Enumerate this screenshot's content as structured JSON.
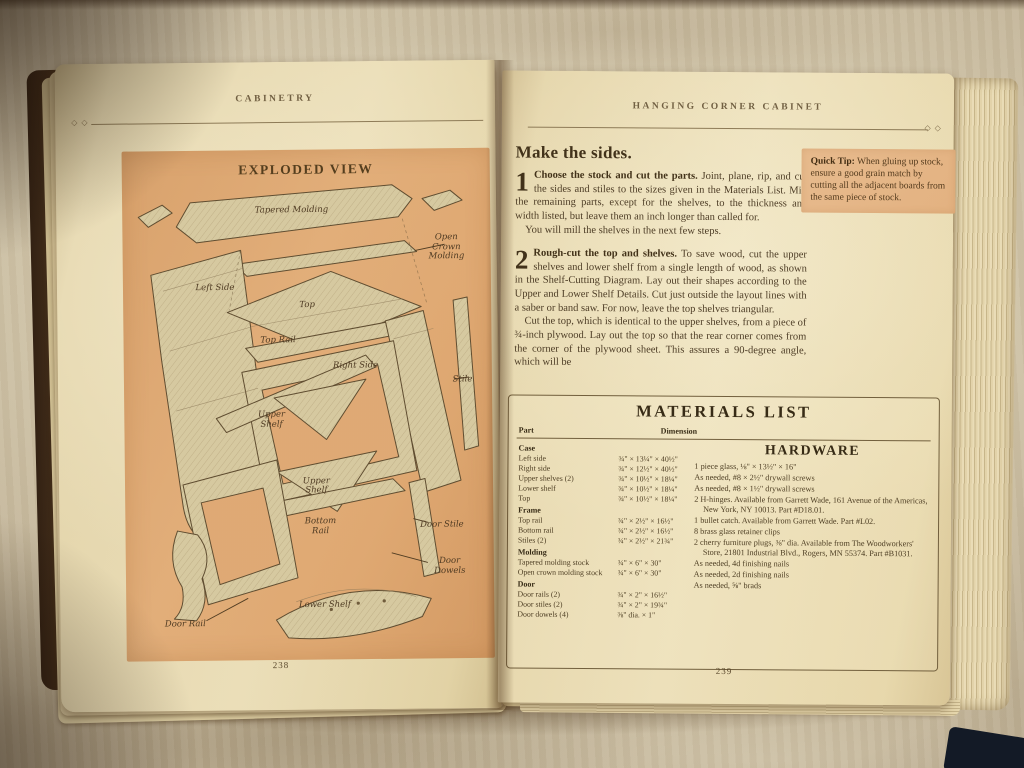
{
  "photo": {
    "description": "Open woodworking book lying on a cream textured blanket",
    "colors": {
      "page_cream": "#f0e6c2",
      "panel_orange": "#e2aa76",
      "tip_orange": "#e9bd8e",
      "blanket": "#d6cdb4",
      "ink": "#3e3322"
    }
  },
  "left_page": {
    "header": "CABINETRY",
    "ornament": "◇ ◇",
    "page_number": "238",
    "panel_title": "EXPLODED VIEW",
    "diagram": {
      "labels": [
        {
          "text": "Tapered Molding",
          "x": 46,
          "y": 12
        },
        {
          "text": "Open Crown\nMolding",
          "x": 88,
          "y": 19.5
        },
        {
          "text": "Left Side",
          "x": 25,
          "y": 27
        },
        {
          "text": "Top",
          "x": 50,
          "y": 30.5
        },
        {
          "text": "Top Rail",
          "x": 42,
          "y": 37.5
        },
        {
          "text": "Right Side",
          "x": 63,
          "y": 42.5
        },
        {
          "text": "Stile",
          "x": 92,
          "y": 45.5
        },
        {
          "text": "Upper\nShelf",
          "x": 40,
          "y": 53
        },
        {
          "text": "Upper\nShelf",
          "x": 52,
          "y": 66
        },
        {
          "text": "Bottom\nRail",
          "x": 53,
          "y": 74
        },
        {
          "text": "Door Stile",
          "x": 86,
          "y": 74
        },
        {
          "text": "Door Dowels",
          "x": 88,
          "y": 82
        },
        {
          "text": "Lower Shelf",
          "x": 54,
          "y": 89.5
        },
        {
          "text": "Door Rail",
          "x": 16,
          "y": 93
        }
      ]
    }
  },
  "right_page": {
    "header": "HANGING CORNER CABINET",
    "ornament": "◇ ◇",
    "page_number": "239",
    "heading": "Make the sides.",
    "steps": [
      {
        "num": "1",
        "lead": "Choose the stock and cut the parts.",
        "text": " Joint, plane, rip, and cut the sides and stiles to the sizes given in the Materials List. Mill the remaining parts, except for the shelves, to the thickness and width listed, but leave them an inch longer than called for.",
        "extra": "You will mill the shelves in the next few steps."
      },
      {
        "num": "2",
        "lead": "Rough-cut the top and shelves.",
        "text": " To save wood, cut the upper shelves and lower shelf from a single length of wood, as shown in the Shelf-Cutting Diagram. Lay out their shapes according to the Upper and Lower Shelf Details. Cut just outside the layout lines with a saber or band saw. For now, leave the top shelves triangular.",
        "extra": "Cut the top, which is identical to the upper shelves, from a piece of ¾-inch plywood. Lay out the top so that the rear corner comes from the corner of the plywood sheet. This assures a 90-degree angle, which will be"
      }
    ],
    "quick_tip": {
      "label": "Quick Tip:",
      "text": " When gluing up stock, ensure a good grain match by cutting all the adjacent boards from the same piece of stock."
    },
    "materials": {
      "title": "MATERIALS LIST",
      "col_part": "Part",
      "col_dimension": "Dimension",
      "sections": [
        {
          "name": "Case",
          "rows": [
            [
              "Left side",
              "¾\" × 13¼\" × 40½\""
            ],
            [
              "Right side",
              "¾\" × 12½\" × 40½\""
            ],
            [
              "Upper shelves (2)",
              "¾\" × 10½\" × 18¼\""
            ],
            [
              "Lower shelf",
              "¾\" × 10½\" × 18¼\""
            ],
            [
              "Top",
              "¾\" × 10½\" × 18¼\""
            ]
          ]
        },
        {
          "name": "Frame",
          "rows": [
            [
              "Top rail",
              "¾\" × 2½\" × 16½\""
            ],
            [
              "Bottom rail",
              "¾\" × 2½\" × 16½\""
            ],
            [
              "Stiles (2)",
              "¾\" × 2½\" × 21¾\""
            ]
          ]
        },
        {
          "name": "Molding",
          "rows": [
            [
              "Tapered molding stock",
              "¾\" × 6\" × 30\""
            ],
            [
              "Open crown molding stock",
              "¾\" × 6\" × 30\""
            ]
          ]
        },
        {
          "name": "Door",
          "rows": [
            [
              "Door rails (2)",
              "¾\" × 2\" × 16½\""
            ],
            [
              "Door stiles (2)",
              "¾\" × 2\" × 19¾\""
            ],
            [
              "Door dowels (4)",
              "⅜\" dia. × 1\""
            ]
          ]
        }
      ],
      "hardware": {
        "title": "HARDWARE",
        "items": [
          "1 piece glass, ⅛\" × 13½\" × 16\"",
          "As needed, #8 × 2½\" drywall screws",
          "As needed, #8 × 1½\" drywall screws",
          "2 H-hinges. Available from Garrett Wade, 161 Avenue of the Americas, New York, NY 10013. Part #D18.01.",
          "1 bullet catch. Available from Garrett Wade. Part #L02.",
          "8 brass glass retainer clips",
          "2 cherry furniture plugs, ⅜\" dia. Available from The Woodworkers' Store, 21801 Industrial Blvd., Rogers, MN 55374. Part #B1031.",
          "As needed, 4d finishing nails",
          "As needed, 2d finishing nails",
          "As needed, ⅝\" brads"
        ]
      }
    }
  }
}
